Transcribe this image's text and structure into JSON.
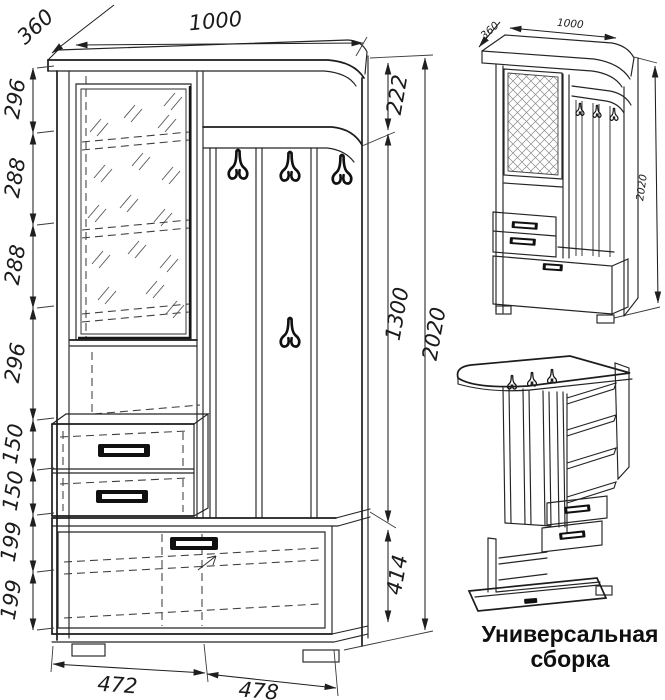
{
  "caption": {
    "line1": "Универсальная",
    "line2": "сборка"
  },
  "front_view": {
    "dim_width_top": "1000",
    "dim_depth": "360",
    "left_chain": [
      "296",
      "288",
      "288",
      "296",
      "150",
      "150",
      "199",
      "199"
    ],
    "right_chain": [
      "222",
      "1300",
      "414"
    ],
    "dim_total_height": "2020",
    "dim_bottom_left": "472",
    "dim_bottom_right": "478"
  },
  "iso_view": {
    "dim_depth": "360",
    "dim_width": "1000",
    "dim_height": "2020"
  },
  "colors": {
    "line": "#222222",
    "background": "#ffffff",
    "hatch": "#8a8a8a"
  }
}
